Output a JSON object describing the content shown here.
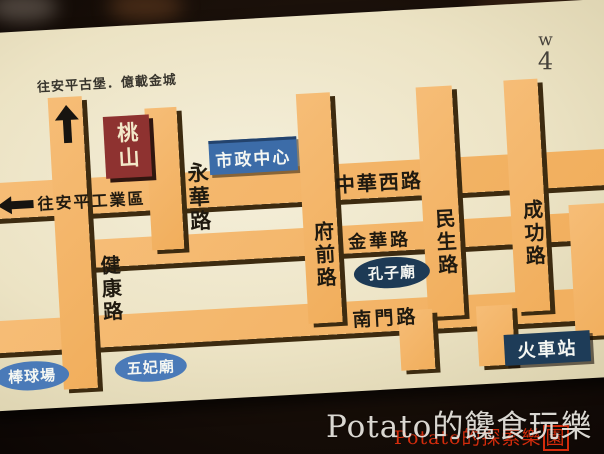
{
  "annotations": {
    "top_direction_note": "往安平古堡．億載金城",
    "left_direction_note": "往安平工業區",
    "handwritten_line1": "w",
    "handwritten_line2": "4"
  },
  "roads": {
    "yonghua": "永華路",
    "zhonghua_west": "中華西路",
    "jiankang": "健康路",
    "fuqian": "府前路",
    "jinhua": "金華路",
    "minsheng": "民生路",
    "chenggong": "成功路",
    "nanmen": "南門路"
  },
  "landmarks": {
    "taoshan_sign": "桃山",
    "city_hall": "市政中心",
    "confucius_temple": "孔子廟",
    "train_station": "火車站",
    "wufei_temple": "五妃廟",
    "baseball_field": "棒球場"
  },
  "watermarks": {
    "primary": "Potato的饞食玩樂",
    "secondary_prefix": "Potato的探索樂",
    "secondary_boxed_char": "園"
  },
  "colors": {
    "road_orange": "#f1ae5c",
    "road_shadow": "#3d2b10",
    "card_cream": "#ece3c4",
    "sign_red": "#8e3230",
    "sign_blue": "#3c6ca8",
    "sign_navy": "#1d3a55",
    "watermark_red": "#d42c0c"
  }
}
